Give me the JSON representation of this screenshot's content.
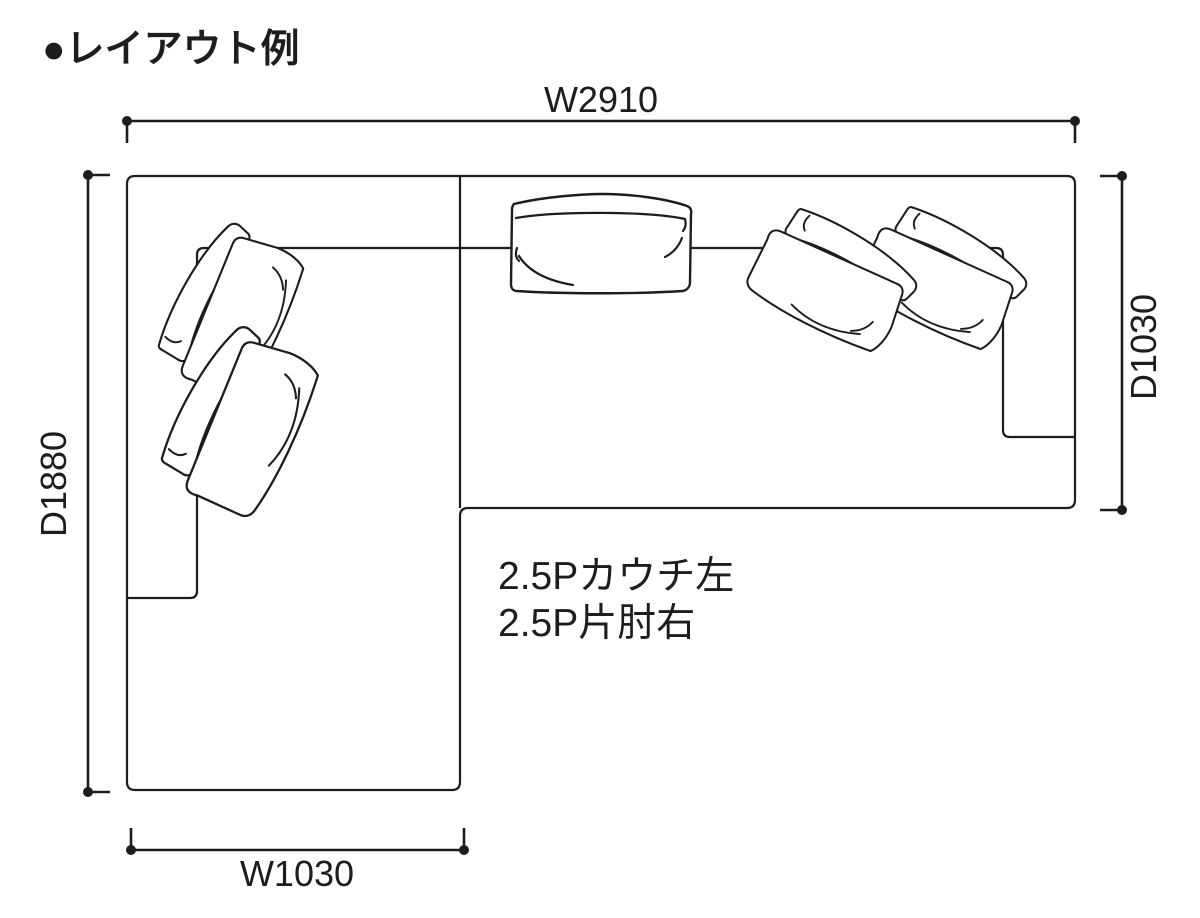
{
  "title": "●レイアウト例",
  "caption": {
    "line1": "2.5Pカウチ左",
    "line2": "2.5P片肘右"
  },
  "dimensions": {
    "top": "W2910",
    "left": "D1880",
    "right": "D1030",
    "bottom": "W1030"
  },
  "colors": {
    "line": "#1d1d1b",
    "background": "#ffffff"
  }
}
